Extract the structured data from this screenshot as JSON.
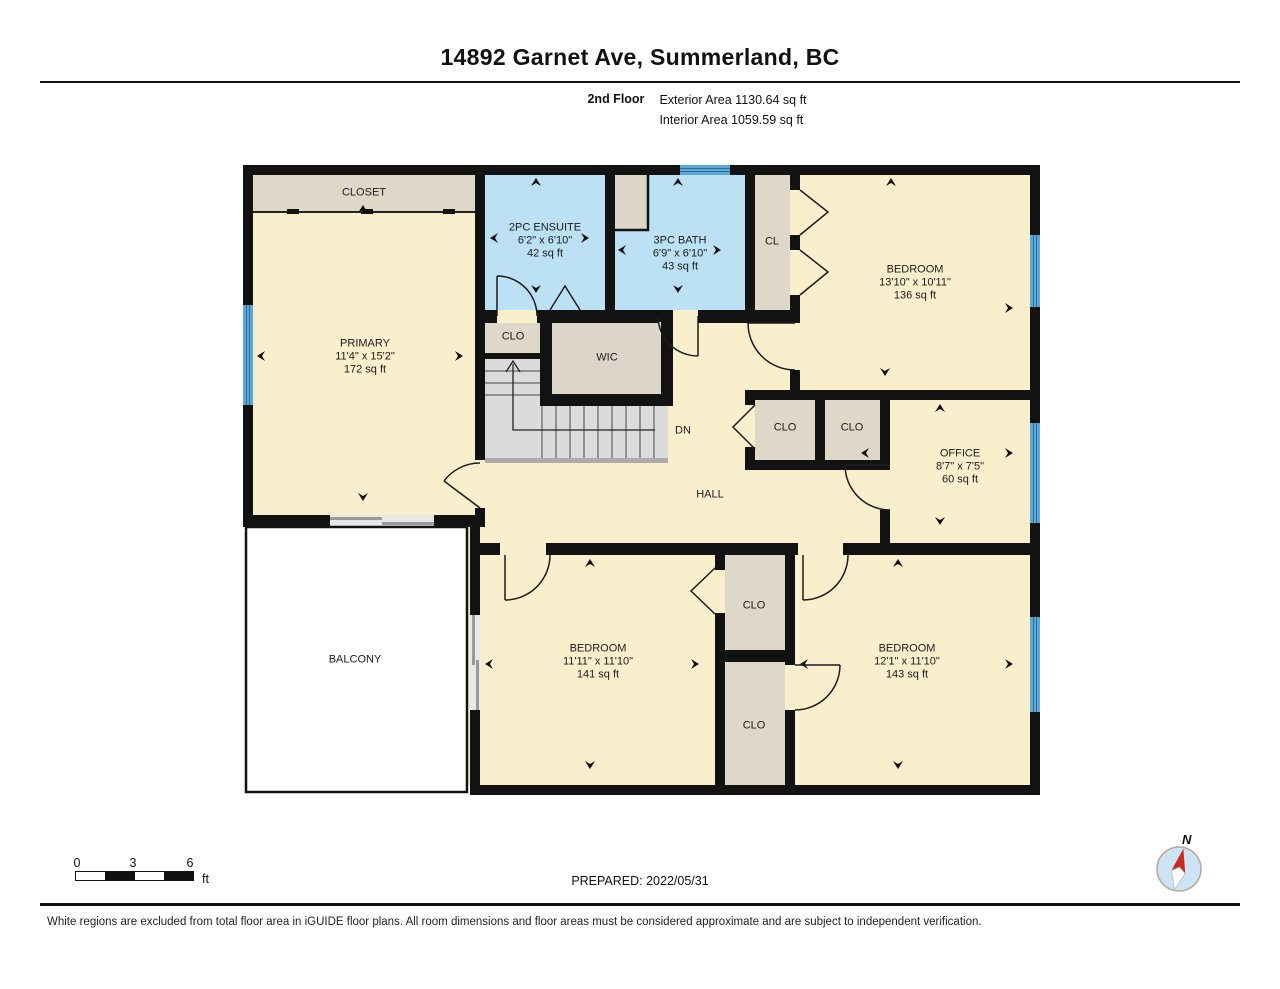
{
  "header": {
    "title": "14892 Garnet Ave, Summerland, BC",
    "floor_label": "2nd Floor",
    "exterior_area": "Exterior Area 1130.64 sq ft",
    "interior_area": "Interior Area 1059.59 sq ft"
  },
  "rooms": {
    "closet_top": {
      "name": "CLOSET"
    },
    "primary": {
      "name": "PRIMARY",
      "dims": "11'4\" x 15'2\"",
      "area": "172 sq ft"
    },
    "ensuite": {
      "name": "2PC ENSUITE",
      "dims": "6'2\" x 6'10\"",
      "area": "42 sq ft"
    },
    "bath": {
      "name": "3PC BATH",
      "dims": "6'9\" x 6'10\"",
      "area": "43 sq ft"
    },
    "cl": {
      "name": "CL"
    },
    "bedroom_ne": {
      "name": "BEDROOM",
      "dims": "13'10\" x 10'11\"",
      "area": "136 sq ft"
    },
    "clo_stairs": {
      "name": "CLO"
    },
    "wic": {
      "name": "WIC"
    },
    "clo_hall_left": {
      "name": "CLO"
    },
    "clo_hall_right": {
      "name": "CLO"
    },
    "office": {
      "name": "OFFICE",
      "dims": "8'7\" x 7'5\"",
      "area": "60 sq ft"
    },
    "stairs_dn": {
      "name": "DN"
    },
    "hall": {
      "name": "HALL"
    },
    "balcony": {
      "name": "BALCONY"
    },
    "bedroom_sw": {
      "name": "BEDROOM",
      "dims": "11'11\" x 11'10\"",
      "area": "141 sq ft"
    },
    "bedroom_se": {
      "name": "BEDROOM",
      "dims": "12'1\" x 11'10\"",
      "area": "143 sq ft"
    },
    "clo_s_upper": {
      "name": "CLO"
    },
    "clo_s_lower": {
      "name": "CLO"
    }
  },
  "footer": {
    "scale_ticks": [
      "0",
      "3",
      "6"
    ],
    "scale_unit": "ft",
    "prepared": "PREPARED: 2022/05/31",
    "compass_label": "N",
    "disclaimer": "White regions are excluded from total floor area in iGUIDE floor plans. All room dimensions and floor areas must be considered approximate and are subject to independent verification."
  },
  "colors": {
    "wall": "#121212",
    "room_fill": "#FAEFCD",
    "closet_fill": "#DFD8C8",
    "bath_fill": "#BCE0F4",
    "window_blue": "#5BA7D6",
    "window_stripe": "#2D6E9D",
    "stairs_gray": "#DBDBDB",
    "compass_needle_red": "#C92A21"
  }
}
